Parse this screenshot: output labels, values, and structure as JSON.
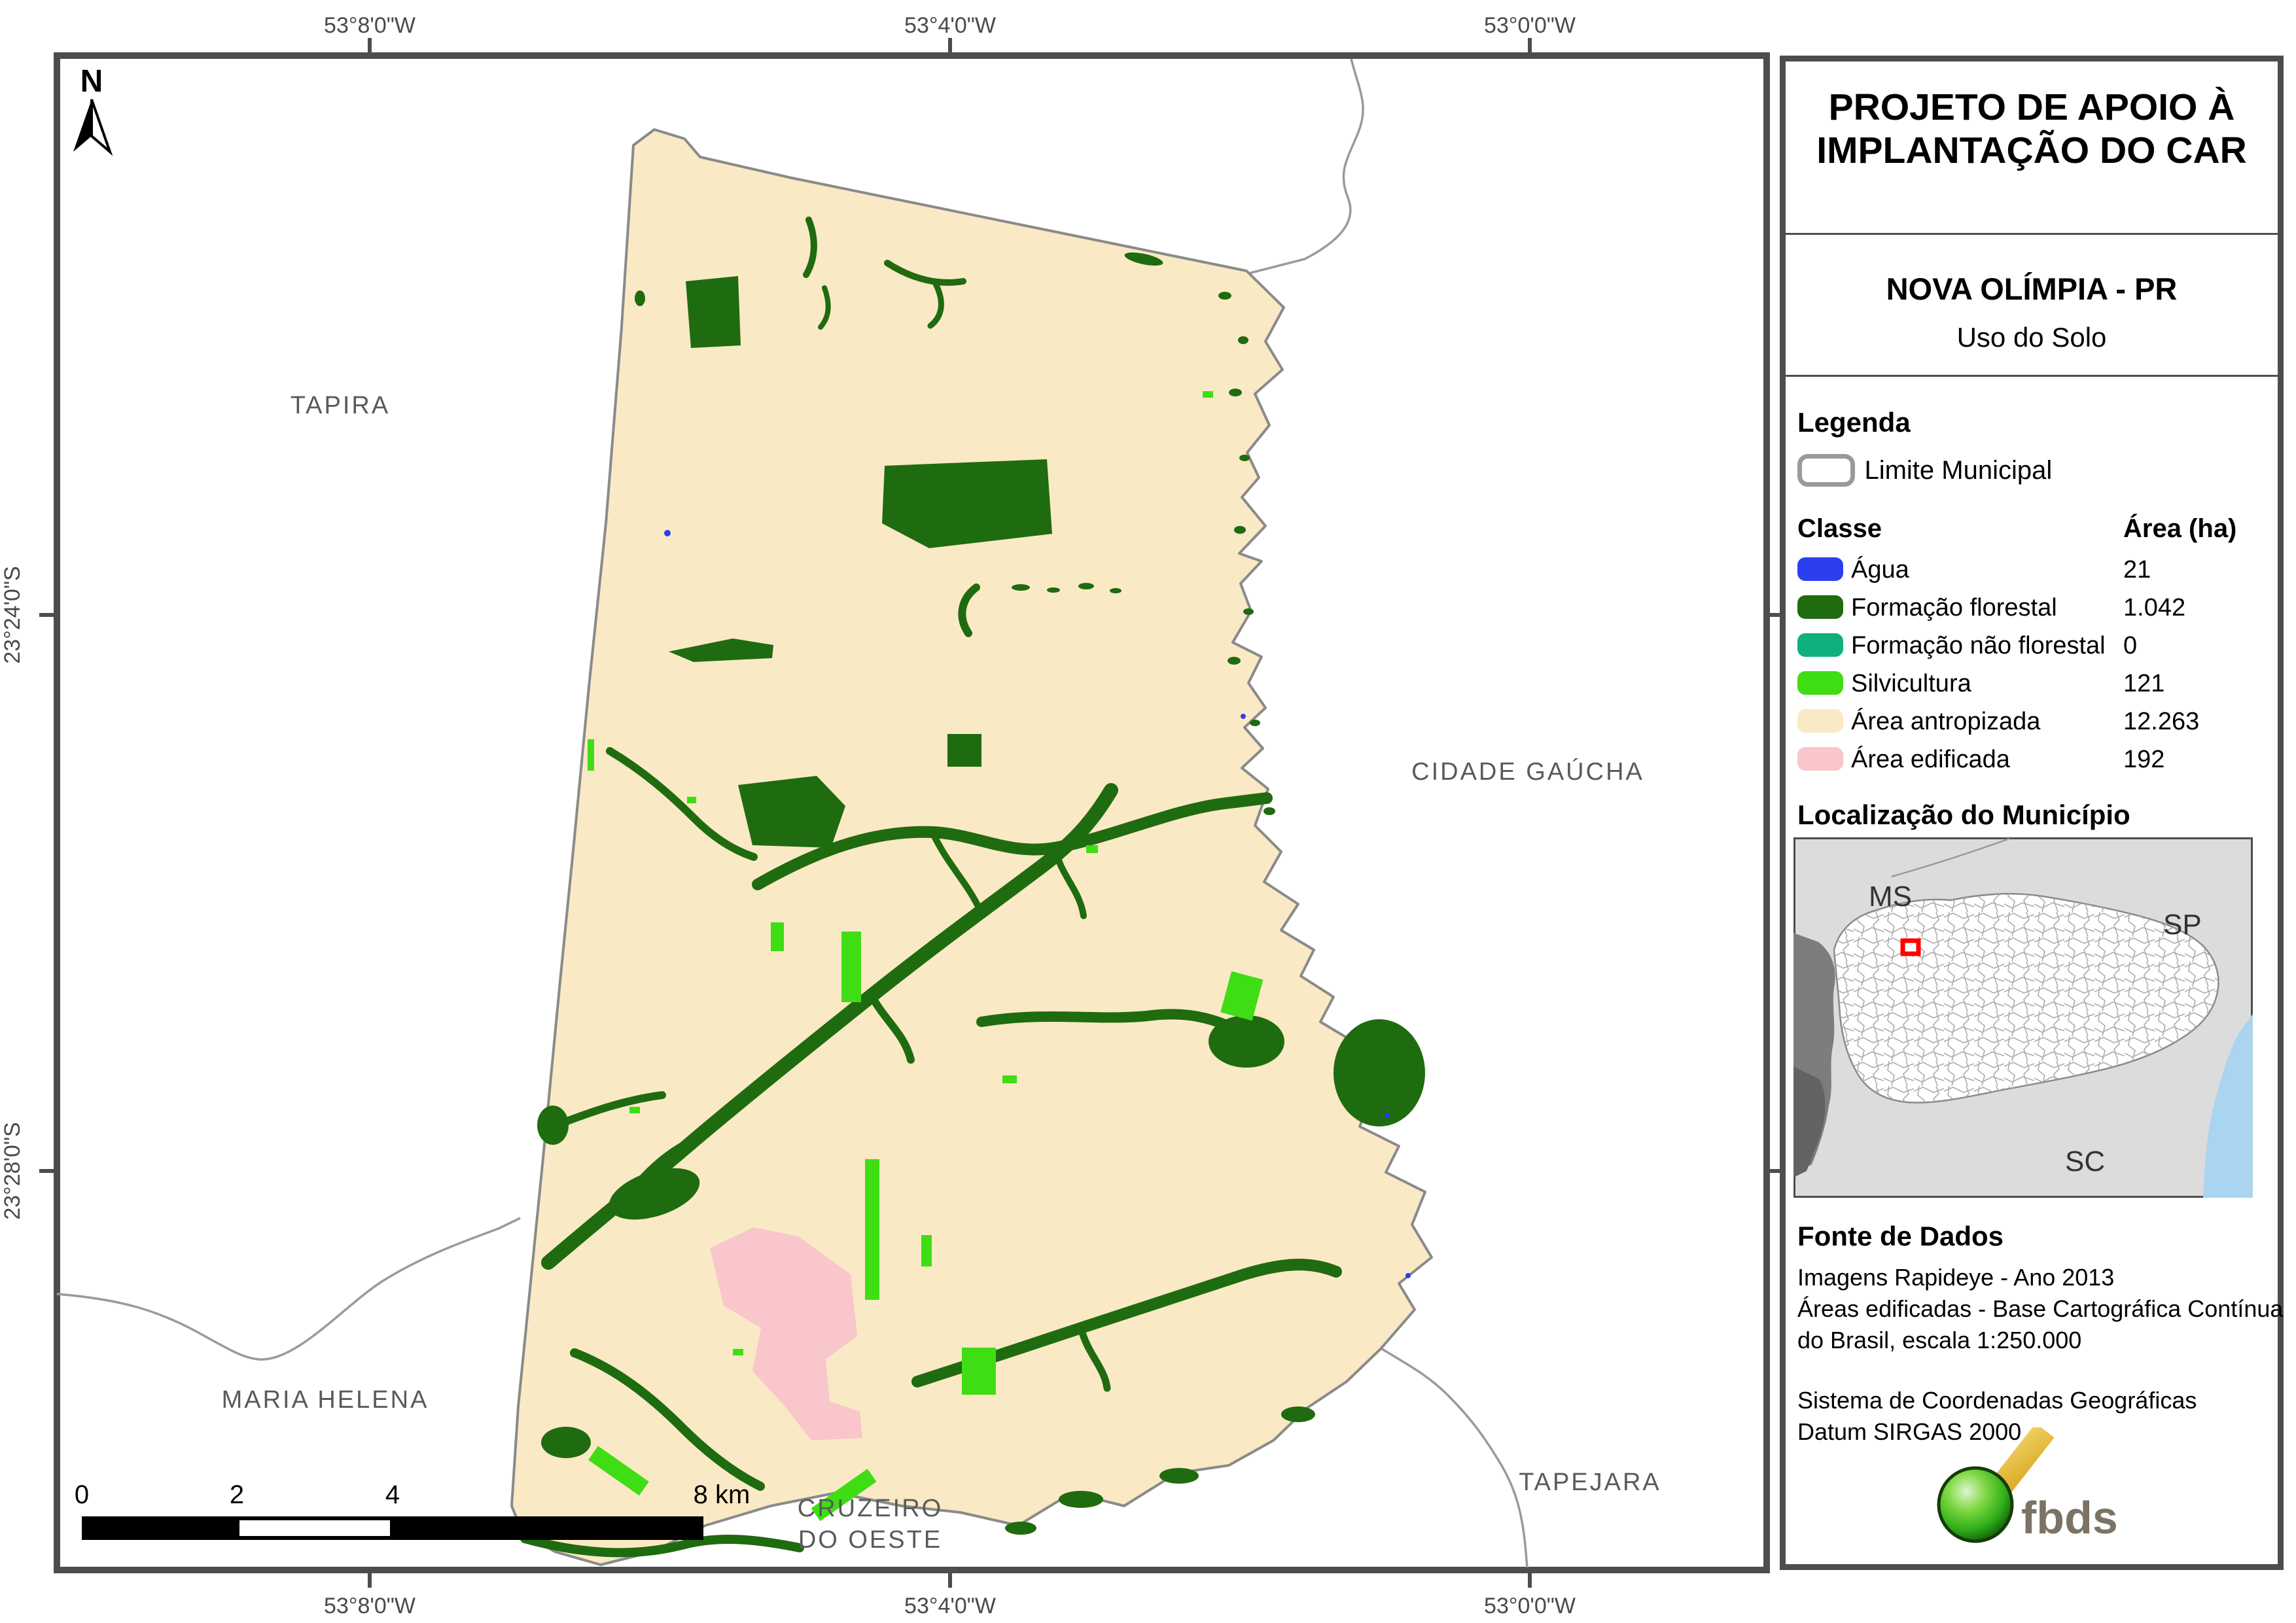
{
  "colors": {
    "water": "#2b3ef0",
    "forest": "#1f6b10",
    "nonforest": "#10b07e",
    "silvi": "#3fdd14",
    "anthro": "#fae9c5",
    "built": "#f9c6cb",
    "limite": "#9a9a9a"
  },
  "map": {
    "north_label": "N",
    "coords": {
      "lon": [
        "53°8'0\"W",
        "53°4'0\"W",
        "53°0'0\"W"
      ],
      "lat": [
        "23°24'0\"S",
        "23°28'0\"S"
      ]
    },
    "neighbors": {
      "tapira": "TAPIRA",
      "cidade_gaucha": "CIDADE GAÚCHA",
      "maria_helena": "MARIA HELENA",
      "cruzeiro_1": "CRUZEIRO",
      "cruzeiro_2": "DO OESTE",
      "tapejara": "TAPEJARA"
    },
    "scalebar": {
      "t0": "0",
      "t1": "2",
      "t2": "4",
      "t3": "8 km"
    }
  },
  "panel": {
    "title": "PROJETO DE APOIO À IMPLANTAÇÃO DO CAR",
    "municipality": "NOVA OLÍMPIA - PR",
    "subtitle": "Uso do Solo",
    "legend": {
      "heading": "Legenda",
      "limite_label": "Limite Municipal",
      "col_class": "Classe",
      "col_area": "Área (ha)",
      "rows": [
        {
          "label": "Água",
          "area": "21",
          "colorKey": "water"
        },
        {
          "label": "Formação florestal",
          "area": "1.042",
          "colorKey": "forest"
        },
        {
          "label": "Formação não florestal",
          "area": "0",
          "colorKey": "nonforest"
        },
        {
          "label": "Silvicultura",
          "area": "121",
          "colorKey": "silvi"
        },
        {
          "label": "Área antropizada",
          "area": "12.263",
          "colorKey": "anthro"
        },
        {
          "label": "Área edificada",
          "area": "192",
          "colorKey": "built"
        }
      ]
    },
    "localizacao": {
      "heading": "Localização do Município",
      "ms": "MS",
      "sp": "SP",
      "sc": "SC"
    },
    "fonte": {
      "heading": "Fonte de Dados",
      "line1": "Imagens Rapideye - Ano 2013",
      "line2": "Áreas edificadas - Base Cartográfica Contínua",
      "line3": "do Brasil, escala 1:250.000",
      "line4": "Sistema de Coordenadas Geográficas",
      "line5": "Datum SIRGAS 2000"
    },
    "logo_text": "fbds"
  }
}
